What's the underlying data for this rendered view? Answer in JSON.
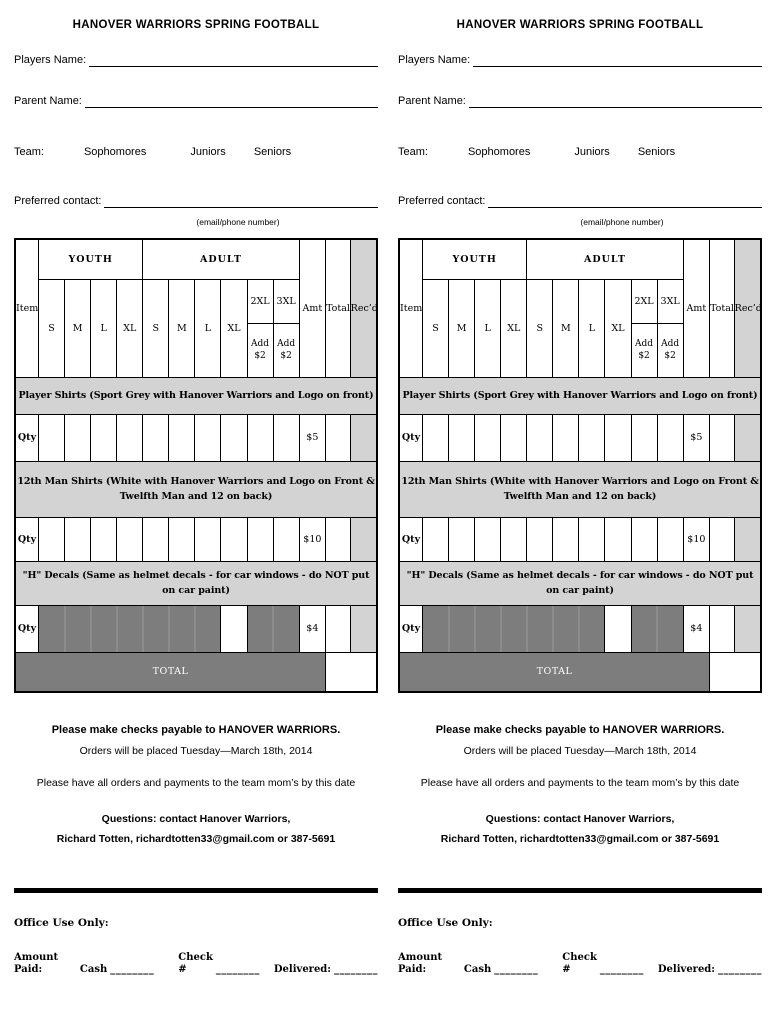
{
  "form": {
    "title": "HANOVER WARRIORS SPRING FOOTBALL",
    "fields": {
      "players_name_label": "Players Name:",
      "parent_name_label": "Parent Name:",
      "team_label": "Team:",
      "team_options": [
        "Sophomores",
        "Juniors",
        "Seniors"
      ],
      "preferred_contact_label": "Preferred contact:",
      "contact_hint": "(email/phone number)"
    },
    "table": {
      "item_header": "Item",
      "youth_header": "YOUTH",
      "adult_header": "ADULT",
      "sizes_youth": [
        "S",
        "M",
        "L",
        "XL"
      ],
      "sizes_adult": [
        "S",
        "M",
        "L",
        "XL"
      ],
      "xxl_label": "2XL",
      "xxxl_label": "3XL",
      "add_fee": "Add $2",
      "amt_header": "Amt",
      "total_header": "Total",
      "recd_header": "Rec’d",
      "qty_label": "Qty",
      "items": [
        {
          "name": "Player Shirts (Sport Grey with Hanover Warriors and Logo on front)",
          "price": "$5"
        },
        {
          "name": "12th Man Shirts (White with Hanover Warriors and Logo on Front & Twelfth Man and 12 on back)",
          "price": "$10"
        },
        {
          "name": "\"H\" Decals (Same as helmet decals - for car windows - do NOT put on car paint)",
          "price": "$4"
        }
      ],
      "total_label": "TOTAL"
    },
    "notes": {
      "checks": "Please make checks payable to HANOVER WARRIORS.",
      "orders": "Orders will be placed Tuesday—March 18th, 2014",
      "deadline": "Please have all orders and payments to the team mom’s by this date",
      "questions": "Questions: contact Hanover Warriors,",
      "contact": "Richard Totten, richardtotten33@gmail.com or 387-5691"
    },
    "office": {
      "office_label": "Office Use Only:",
      "amount_paid_label": "Amount Paid:",
      "cash_label": "Cash",
      "check_label": "Check #",
      "delivered_label": "Delivered:",
      "blank": "________"
    },
    "colors": {
      "band_grey": "#d3d3d3",
      "dark_grey": "#7d7d7d"
    }
  }
}
